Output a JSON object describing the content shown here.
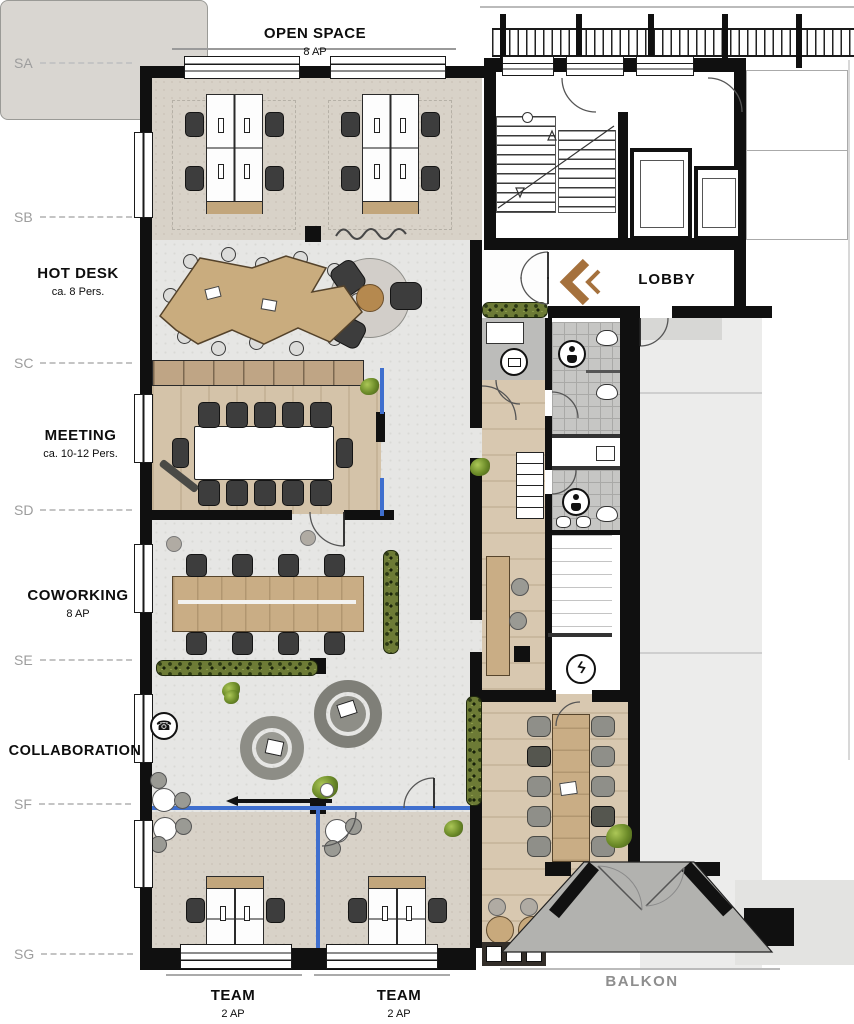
{
  "plan": {
    "zones": {
      "open_space": {
        "title": "OPEN SPACE",
        "subtitle": "8 AP"
      },
      "hot_desk": {
        "title": "HOT DESK",
        "subtitle": "ca. 8 Pers."
      },
      "meeting": {
        "title": "MEETING",
        "subtitle": "ca. 10-12 Pers."
      },
      "coworking": {
        "title": "COWORKING",
        "subtitle": "8 AP"
      },
      "collaboration": {
        "title": "COLLABORATION"
      },
      "team_left": {
        "title": "TEAM",
        "subtitle": "2 AP"
      },
      "team_right": {
        "title": "TEAM",
        "subtitle": "2 AP"
      },
      "lobby": {
        "title": "LOBBY"
      },
      "balkon": {
        "title": "BALKON"
      }
    },
    "grid_labels": [
      "SA",
      "SB",
      "SC",
      "SD",
      "SE",
      "SF",
      "SG"
    ],
    "icons": {
      "phone": "☎",
      "lightning": "ϟ"
    },
    "colors": {
      "wall": "#101010",
      "glass_partition": "#3f6fce",
      "entry_arrow": "#a5713d",
      "wood_floor": "#d4c3a9",
      "carpet": "#d8d2c8",
      "concrete": "#e6e6e4",
      "hedge": "#6d7b36",
      "balcony": "#b2b2af"
    }
  }
}
